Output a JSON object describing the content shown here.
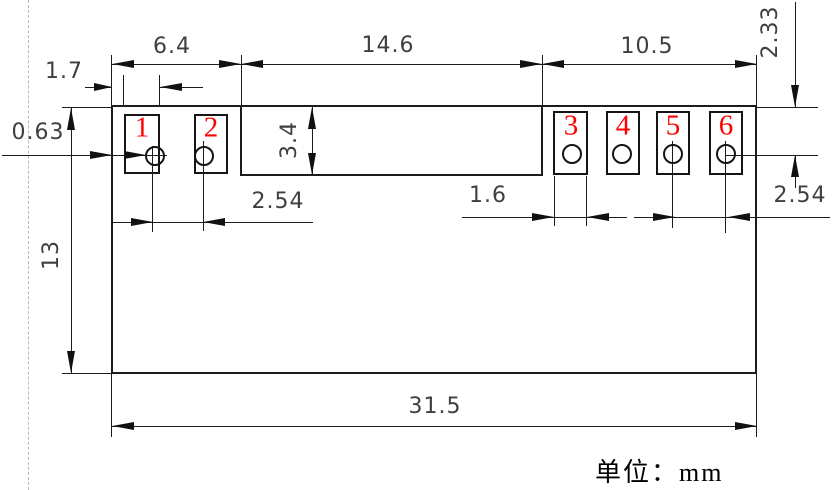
{
  "drawing": {
    "type_note": "component footprint dimension drawing",
    "units_note": "单位：mm",
    "pads": [
      {
        "label": "1"
      },
      {
        "label": "2"
      },
      {
        "label": "3"
      },
      {
        "label": "4"
      },
      {
        "label": "5"
      },
      {
        "label": "6"
      }
    ],
    "dims": {
      "top_left": "6.4",
      "top_middle": "14.6",
      "top_right": "10.5",
      "pad_width_left": "1.7",
      "edge_gap": "0.63",
      "notch_depth": "3.4",
      "pitch_left": "2.54",
      "pad_width_right": "1.6",
      "pitch_right": "2.54",
      "hole_offset_top": "2.33",
      "body_height": "13",
      "overall_width": "31.5"
    },
    "colors": {
      "line": "#1c1c1c",
      "dim_text": "#3f3f3f",
      "pad_number": "#ff0000",
      "dashed_guide": "#b8b8b8"
    }
  }
}
